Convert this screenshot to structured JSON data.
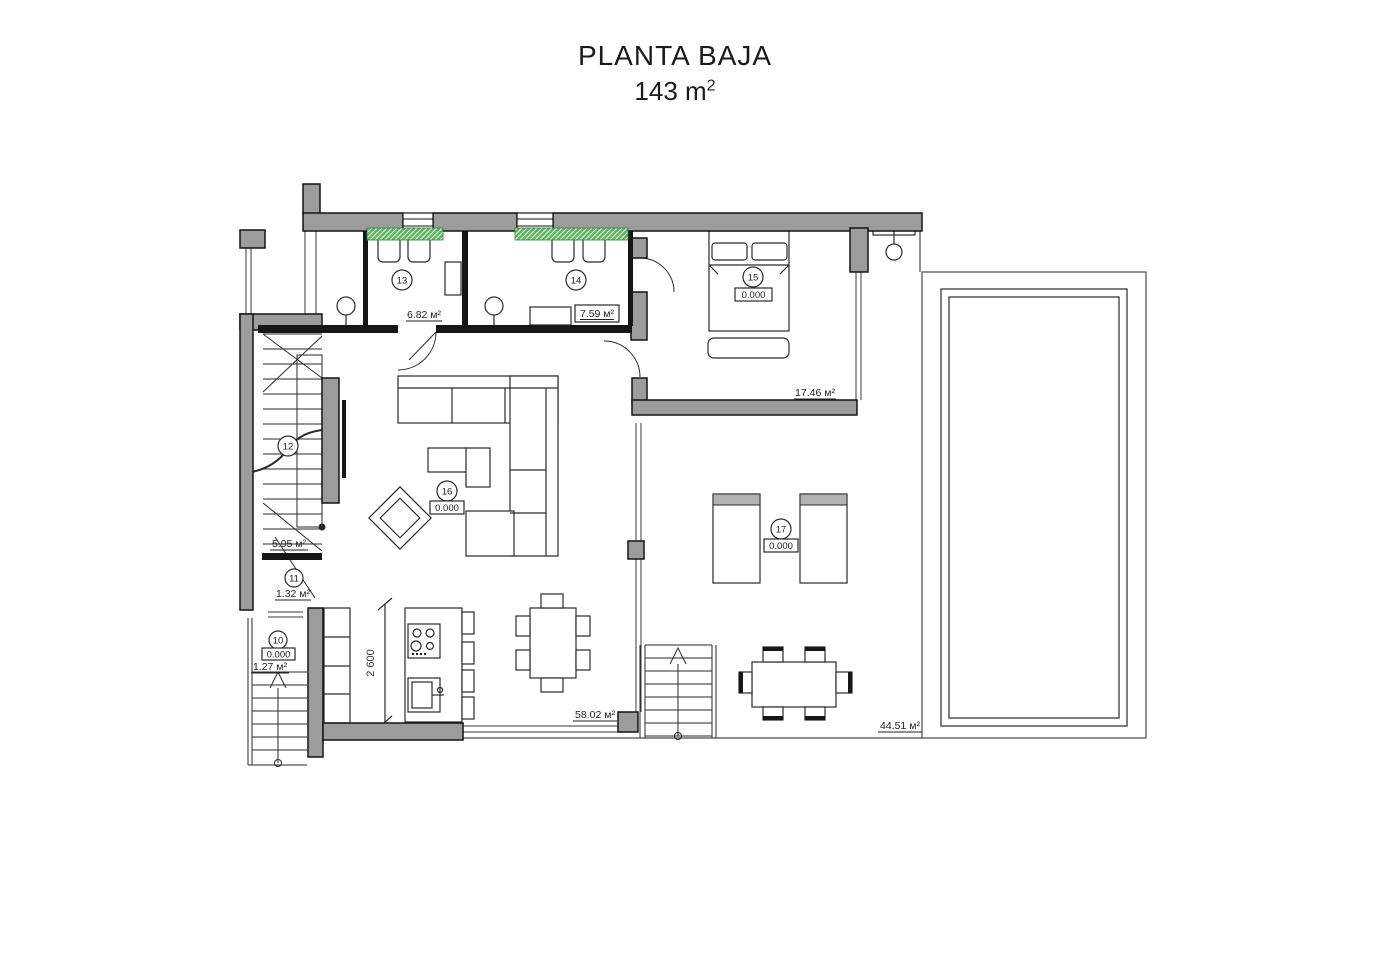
{
  "title": {
    "line1": "PLANTA BAJA",
    "line2": "143 m",
    "line2_sup": "2"
  },
  "rooms": {
    "r10": {
      "number": "10",
      "level": "0.000",
      "area": "1.27 м²"
    },
    "r11": {
      "number": "11",
      "area": "1.32 м²"
    },
    "r12": {
      "number": "12",
      "area": "5.95 м²"
    },
    "r13": {
      "number": "13",
      "area": "6.82 м²"
    },
    "r14": {
      "number": "14",
      "area": "7.59 м²"
    },
    "r15": {
      "number": "15",
      "level": "0.000",
      "area": "17.46 м²"
    },
    "r16": {
      "number": "16",
      "level": "0.000",
      "area": "58.02 м²"
    },
    "r17": {
      "number": "17",
      "level": "0.000",
      "area": "44.51 м²"
    }
  },
  "dimensions": {
    "kitchen_width": "2 600"
  },
  "colors": {
    "wall": "#9c9c9c",
    "line": "#141414",
    "glass_strip_green": "#57b75b"
  }
}
